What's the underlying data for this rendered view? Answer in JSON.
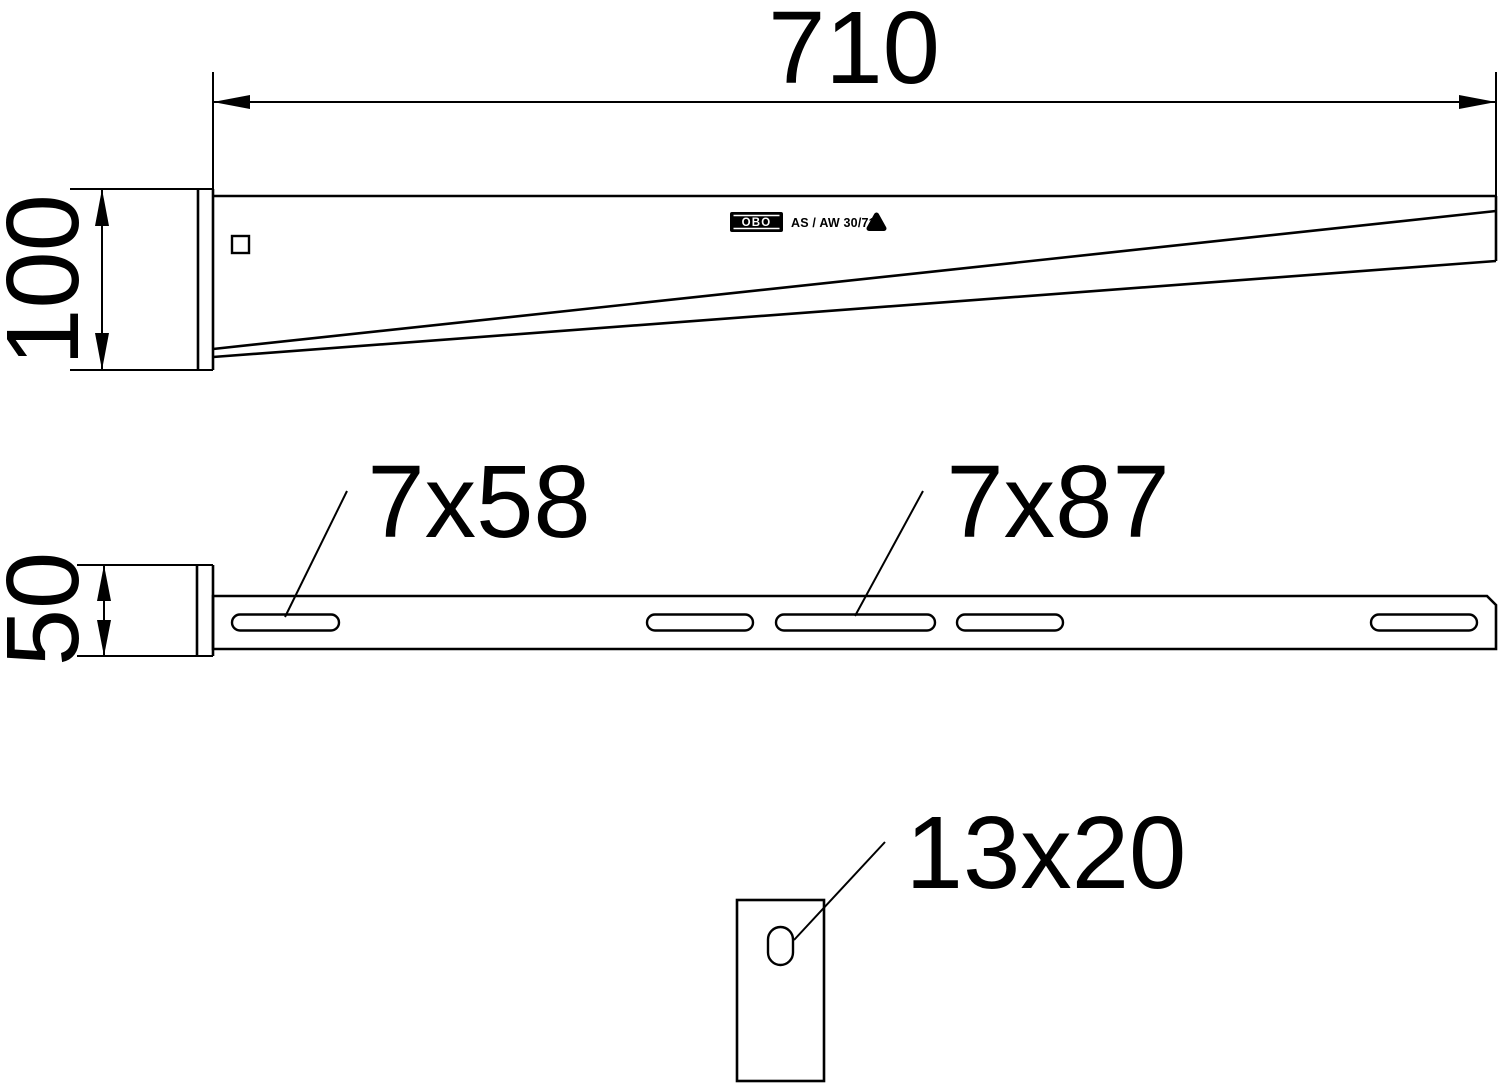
{
  "drawing": {
    "side_view": {
      "length_dim": "710",
      "plate_height_dim": "100",
      "stamp": {
        "brand": "OBO",
        "model": "AS / AW 30/71"
      }
    },
    "plan_view": {
      "plate_width_dim": "50",
      "small_slot_label": "7x58",
      "large_slot_label": "7x87"
    },
    "front_view": {
      "oblong_hole_label": "13x20"
    },
    "colors": {
      "ink": "#000000",
      "paper": "#ffffff"
    }
  }
}
